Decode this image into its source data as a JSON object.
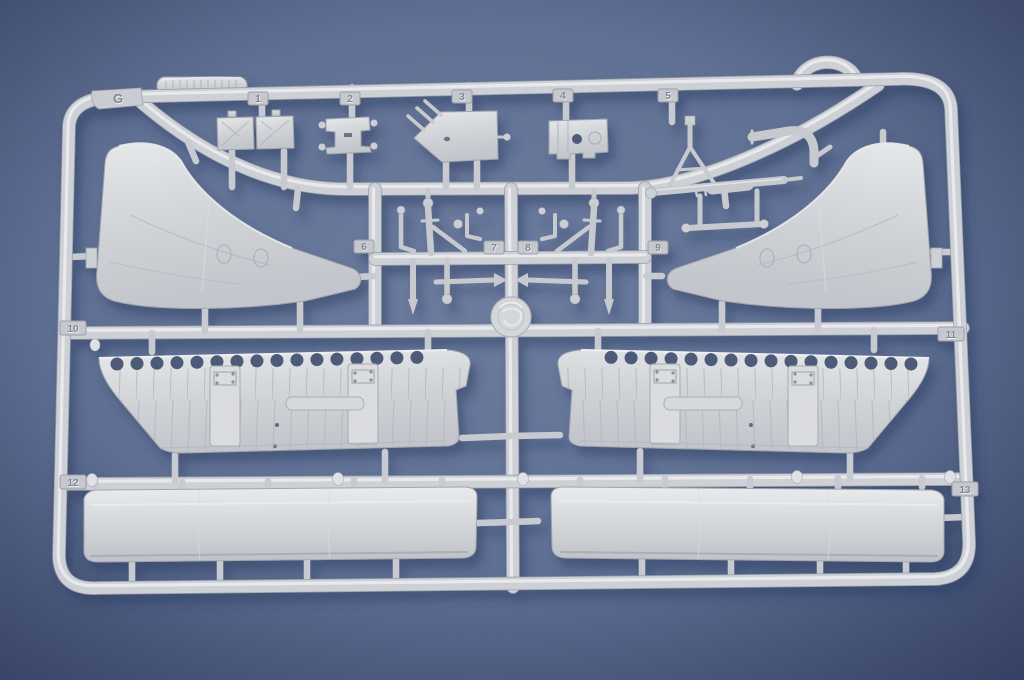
{
  "scene": {
    "type": "photograph",
    "description": "Light-grey injection-moulded plastic sprue (runner) of a scale model aircraft kit photographed on a mottled blue background",
    "background_color": "#6b7da5",
    "plastic_color": "#ced1d5",
    "shadow_color": "#2c3b63"
  },
  "sprue": {
    "frame_letter": "G",
    "tags": {
      "g": "G",
      "n1": "1",
      "n2": "2",
      "n3": "3",
      "n4": "4",
      "n5": "5",
      "n6": "6",
      "n7": "7",
      "n8": "8",
      "n9": "9",
      "n10": "10",
      "n11": "11",
      "n12": "12",
      "n13": "13"
    },
    "parts": [
      "wing-panel-left",
      "wing-panel-right",
      "spar-with-lightening-holes-left",
      "spar-with-lightening-holes-right",
      "flap-panel-left",
      "flap-panel-right",
      "hatch-doors-part",
      "bracket-part",
      "ribbed-plate-part",
      "box-part",
      "landing-gear-strut-assembly",
      "small-strut-cluster-left",
      "small-strut-cluster-right",
      "ribbed-strip-part",
      "molding-boss",
      "hanging-loop"
    ]
  }
}
